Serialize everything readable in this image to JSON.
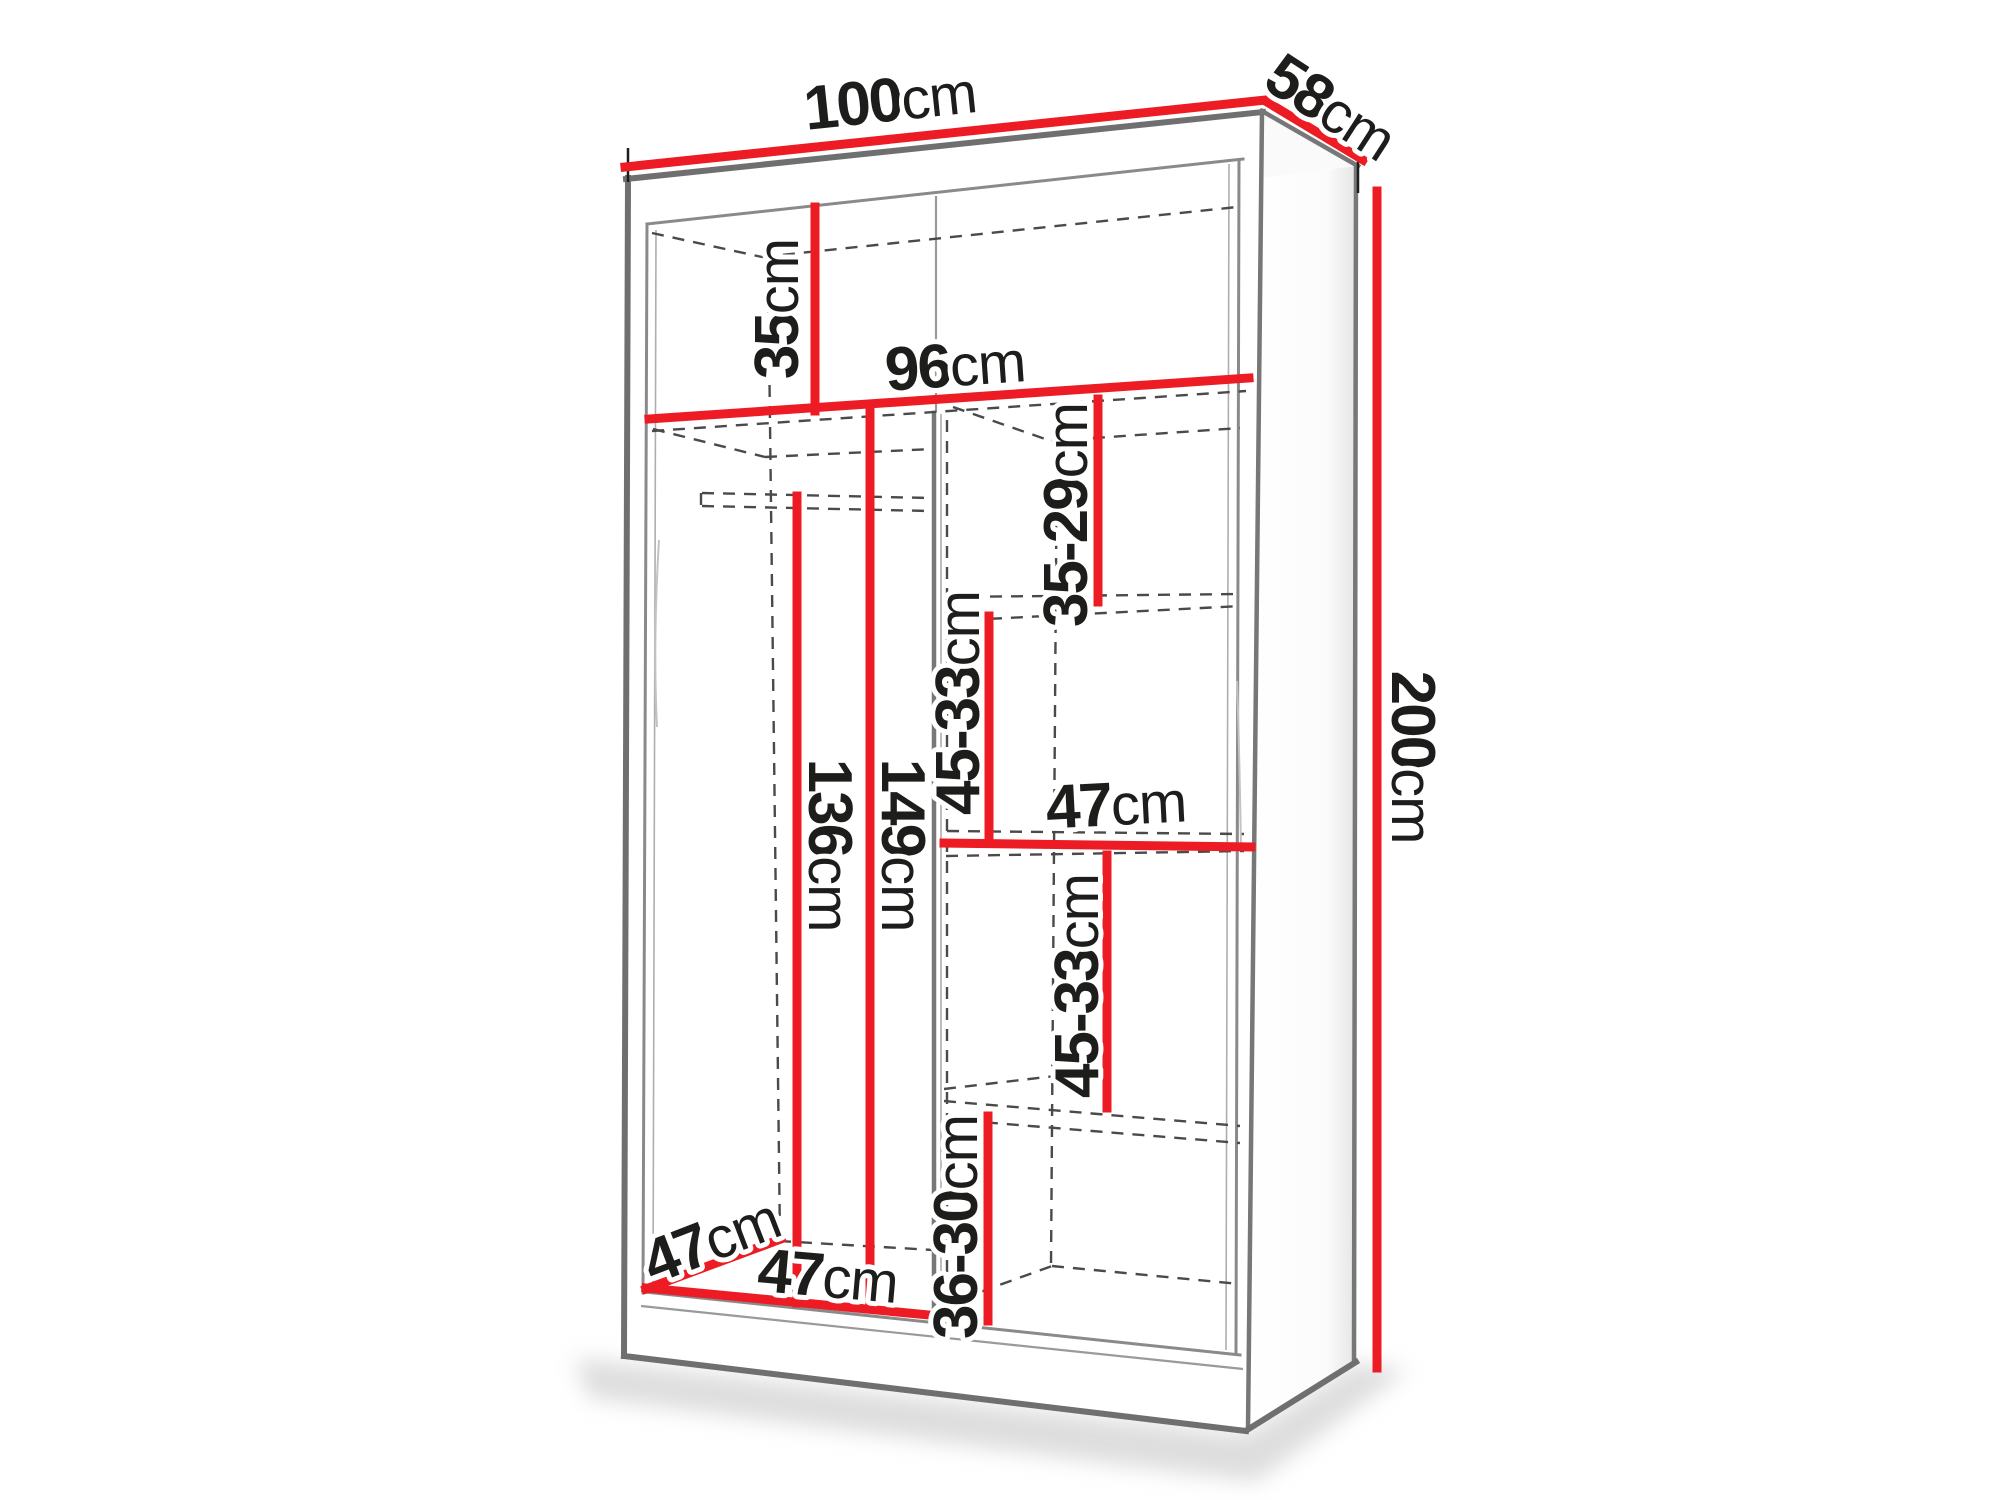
{
  "diagram": {
    "exterior": {
      "width": {
        "num": "100",
        "unit": "cm"
      },
      "depth": {
        "num": "58",
        "unit": "cm"
      },
      "height": {
        "num": "200",
        "unit": "cm"
      }
    },
    "interior": {
      "top_compartment_height": {
        "num": "35",
        "unit": "cm"
      },
      "interior_width": {
        "num": "96",
        "unit": "cm"
      },
      "gap_shelf_1": {
        "num": "35-29",
        "unit": "cm"
      },
      "gap_shelf_2": {
        "num": "45-33",
        "unit": "cm"
      },
      "right_shelf_width": {
        "num": "47",
        "unit": "cm"
      },
      "gap_shelf_3": {
        "num": "45-33",
        "unit": "cm"
      },
      "gap_shelf_4": {
        "num": "36-30",
        "unit": "cm"
      },
      "left_height_to_rail": {
        "num": "136",
        "unit": "cm"
      },
      "left_height_to_shelf": {
        "num": "149",
        "unit": "cm"
      },
      "interior_depth": {
        "num": "47",
        "unit": "cm"
      },
      "left_section_width": {
        "num": "47",
        "unit": "cm"
      }
    },
    "colors": {
      "dimension_red": "#ed1c24",
      "outline_gray": "#6f6f6f",
      "construction_dash_gray": "#4a4a4a",
      "label_text": "#1d1d1b",
      "background": "#ffffff"
    }
  }
}
